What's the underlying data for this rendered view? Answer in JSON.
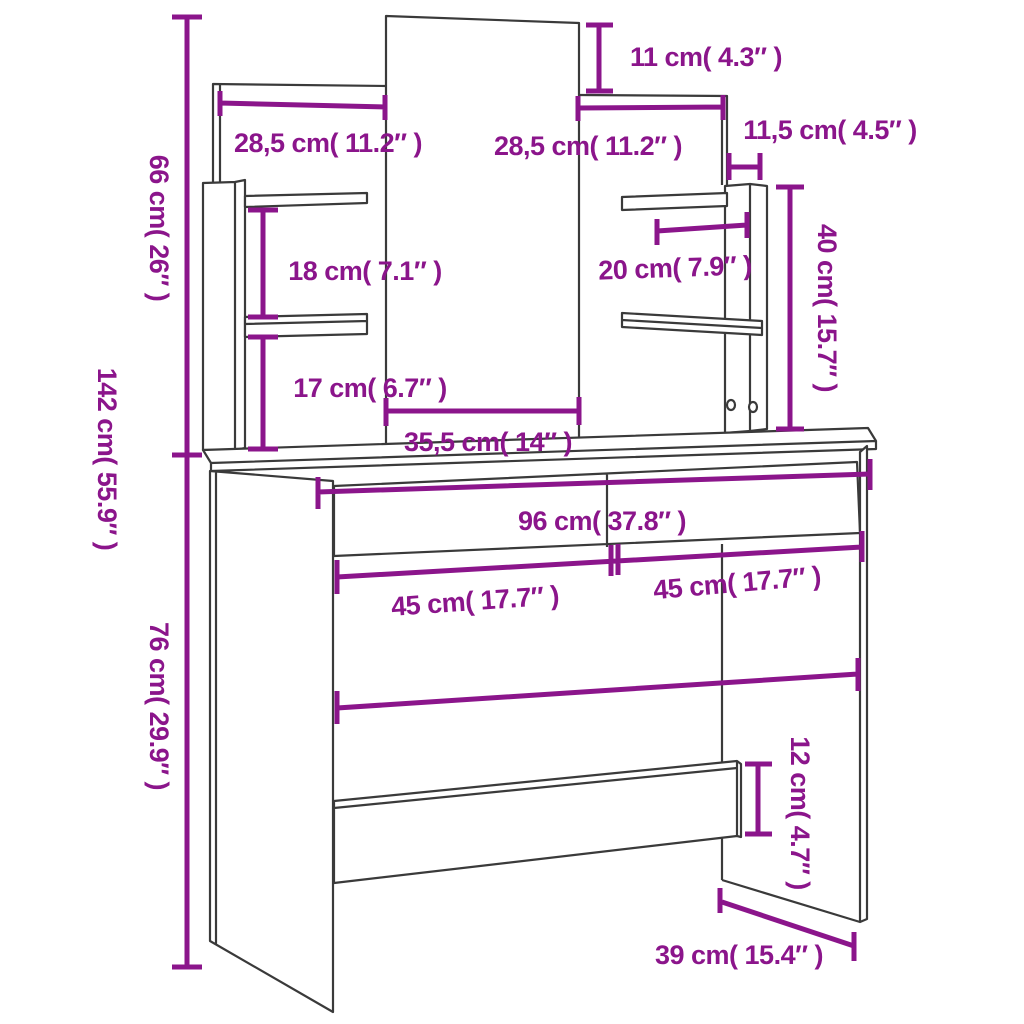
{
  "colors": {
    "dimension": "#8B158B",
    "outline": "#3A3A3A",
    "background": "#FFFFFF"
  },
  "labels": {
    "total_height": "142 cm( 55.9″ )",
    "upper_section_height": "66 cm( 26″ )",
    "table_height": "76 cm( 29.9″ )",
    "mirror_top_offset": "11 cm( 4.3″ )",
    "left_panel_width": "28,5 cm( 11.2″ )",
    "right_panel_width": "28,5 cm( 11.2″ )",
    "side_column_gap": "11,5 cm( 4.5″ )",
    "shelf_column_height": "40 cm( 15.7″ )",
    "left_shelf_gap_upper": "18 cm( 7.1″ )",
    "right_shelf_width": "20 cm( 7.9″ )",
    "left_shelf_gap_lower": "17 cm( 6.7″ )",
    "mirror_width": "35,5 cm( 14″ )",
    "tabletop_width": "96 cm( 37.8″ )",
    "left_drawer_width": "45 cm( 17.7″ )",
    "right_drawer_width": "45 cm( 17.7″ )",
    "stretcher_height": "12 cm( 4.7″ )",
    "base_depth": "39 cm( 15.4″ )"
  }
}
